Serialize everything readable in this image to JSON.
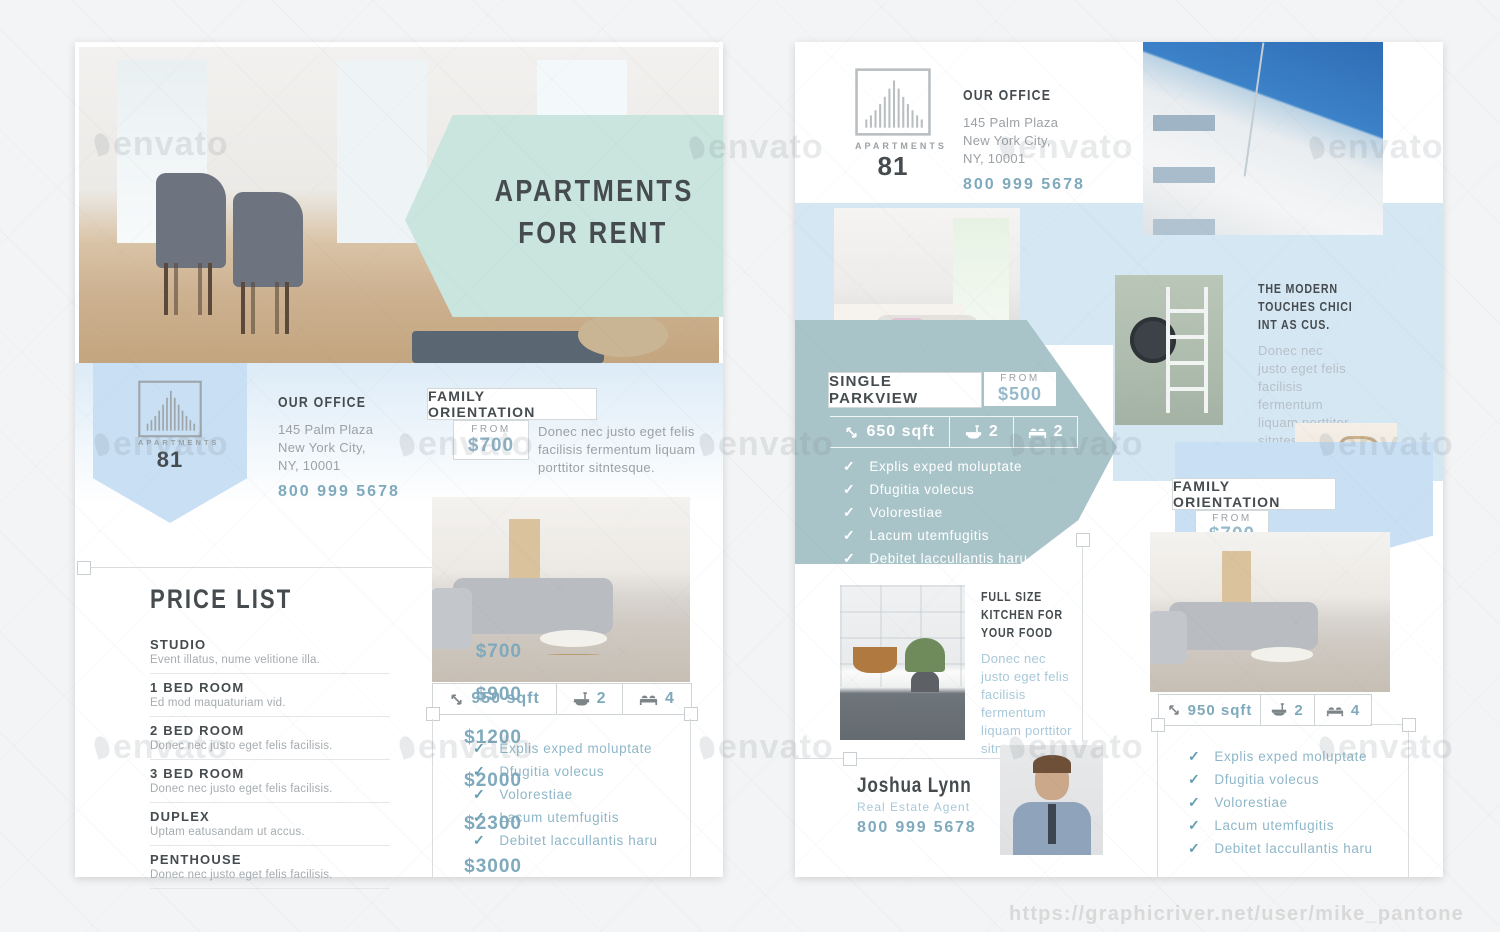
{
  "site": {
    "credit_url": "https://graphicriver.net/user/mike_pantone",
    "watermark_text": "envato"
  },
  "brand": {
    "name": "APARTMENTS",
    "number": "81"
  },
  "colors": {
    "mint": "#c9e5de",
    "slate": "#a9c4c9",
    "band_blue": "#d6e7f4",
    "pentagon_blue": "#c9e0f4",
    "accent_teal": "#7fa9bc",
    "heading_dark": "#454b4e"
  },
  "left_page": {
    "hero": {
      "title_line1": "APARTMENTS",
      "title_line2": "FOR RENT"
    },
    "office": {
      "heading": "OUR OFFICE",
      "address_line1": "145 Palm Plaza",
      "address_line2": "New York City,",
      "address_line3": "NY, 10001",
      "phone": "800 999 5678"
    },
    "family": {
      "title": "FAMILY ORIENTATION",
      "from_label": "FROM",
      "price": "$700",
      "description": "Donec nec justo eget felis facilisis fermentum liquam porttitor sitntesque."
    },
    "specs": {
      "area": "950 sqft",
      "baths": "2",
      "beds": "4"
    },
    "checklist": [
      "Explis exped moluptate",
      "Dfugitia volecus",
      "Volorestiae",
      "Lacum utemfugitis",
      "Debitet laccullantis haru"
    ],
    "price_list": {
      "title": "PRICE LIST",
      "items": [
        {
          "name": "STUDIO",
          "desc": "Event illatus, nume velitione illa.",
          "price": "$700"
        },
        {
          "name": "1 BED ROOM",
          "desc": "Ed mod maquaturiam vid.",
          "price": "$900"
        },
        {
          "name": "2 BED ROOM",
          "desc": "Donec nec justo eget felis facilisis.",
          "price": "$1200"
        },
        {
          "name": "3 BED ROOM",
          "desc": "Donec nec justo eget felis facilisis.",
          "price": "$2000"
        },
        {
          "name": "DUPLEX",
          "desc": "Uptam eatusandam ut accus.",
          "price": "$2300"
        },
        {
          "name": "PENTHOUSE",
          "desc": "Donec nec justo eget felis facilisis.",
          "price": "$3000"
        }
      ]
    }
  },
  "right_page": {
    "office": {
      "heading": "OUR OFFICE",
      "address_line1": "145 Palm Plaza",
      "address_line2": "New York City,",
      "address_line3": "NY, 10001",
      "phone": "800 999 5678"
    },
    "single_parkview": {
      "title": "SINGLE PARKVIEW",
      "from_label": "FROM",
      "price": "$500",
      "specs": {
        "area": "650 sqft",
        "baths": "2",
        "beds": "2"
      },
      "checklist": [
        "Explis exped moluptate",
        "Dfugitia volecus",
        "Volorestiae",
        "Lacum utemfugitis",
        "Debitet laccullantis haru"
      ]
    },
    "modern": {
      "heading_line1": "THE MODERN",
      "heading_line2": "TOUCHES CHICI",
      "heading_line3": "INT AS CUS.",
      "body": "Donec nec justo eget felis facilisis fermentum liquam porttitor sitntesque."
    },
    "family": {
      "title": "FAMILY ORIENTATION",
      "from_label": "FROM",
      "price": "$700",
      "specs": {
        "area": "950 sqft",
        "baths": "2",
        "beds": "4"
      },
      "checklist": [
        "Explis exped moluptate",
        "Dfugitia volecus",
        "Volorestiae",
        "Lacum utemfugitis",
        "Debitet laccullantis haru"
      ]
    },
    "kitchen": {
      "heading_line1": "FULL SIZE",
      "heading_line2": "KITCHEN FOR",
      "heading_line3": "YOUR FOOD",
      "body": "Donec nec justo eget felis facilisis fermentum liquam porttitor sitntesque."
    },
    "agent": {
      "name": "Joshua Lynn",
      "role": "Real Estate Agent",
      "phone": "800 999 5678"
    }
  }
}
